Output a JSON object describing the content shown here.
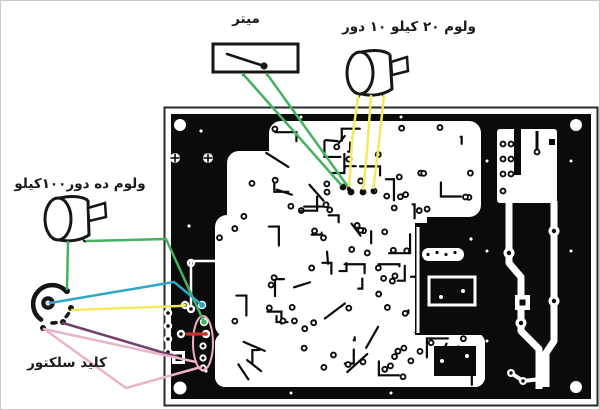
{
  "figure": {
    "type": "pcb-wiring-diagram"
  },
  "components": {
    "meter": {
      "label": "میتر"
    },
    "pot_20k": {
      "label": "ولوم ۲۰ کیلو ۱۰ دور"
    },
    "pot_100k": {
      "label": "ولوم ده دور۱۰۰کیلو"
    },
    "selector": {
      "label": "کلید سلکتور"
    }
  },
  "colors": {
    "board_black": "#0b0b0b",
    "trace_white": "#ffffff",
    "outline_ink": "#161616",
    "wire_green": "#46b261",
    "wire_yellow": "#f3e95c",
    "wire_cyan": "#2ea7c2",
    "wire_purple": "#71406d",
    "wire_pink": "#eab3cb",
    "wire_red": "#c53430",
    "highlight_pink": "#f2aec6"
  }
}
